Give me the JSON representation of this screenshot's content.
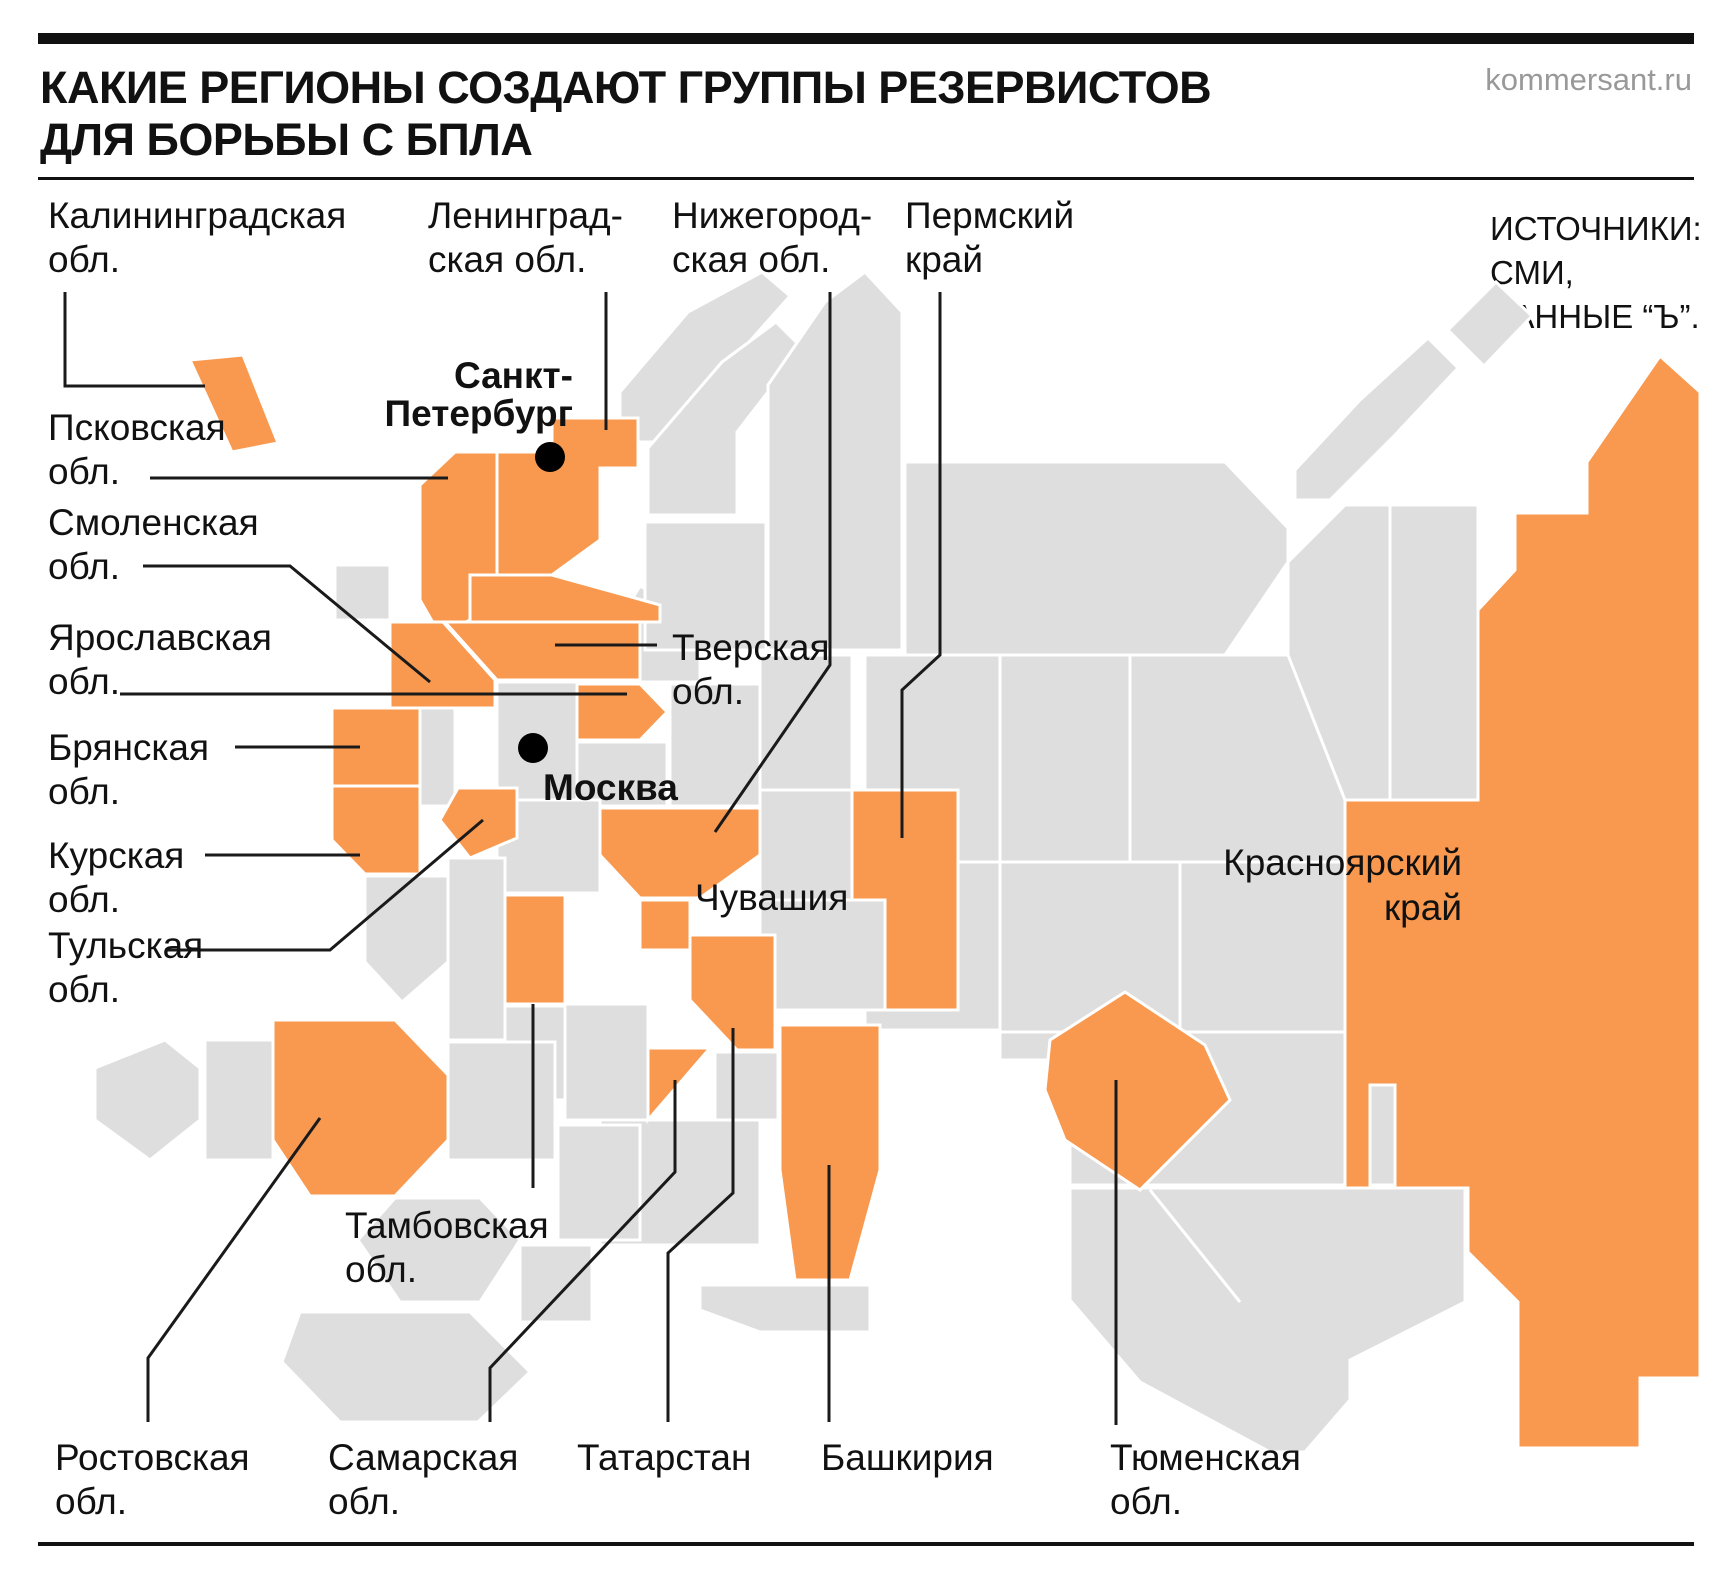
{
  "colors": {
    "accent": "#F9994F",
    "region": "#DEDEDE",
    "ink": "#111111",
    "muted": "#999999",
    "line": "#1A1A1A"
  },
  "header": {
    "title_line1": "КАКИЕ РЕГИОНЫ СОЗДАЮТ ГРУППЫ РЕЗЕРВИСТОВ",
    "title_line2": "ДЛЯ БОРЬБЫ С БПЛА",
    "site": "kommersant.ru"
  },
  "sources": {
    "line1": "ИСТОЧНИКИ:",
    "line2": "СМИ,",
    "line3": "ДАННЫЕ “Ъ”."
  },
  "cities": {
    "spb": [
      "Санкт-",
      "Петербург"
    ],
    "moscow": [
      "Москва"
    ]
  },
  "regions": {
    "kaliningrad": [
      "Калининградская",
      "обл."
    ],
    "leningrad": [
      "Ленинград-",
      "ская обл."
    ],
    "nizhny": [
      "Нижегород-",
      "ская обл."
    ],
    "perm": [
      "Пермский",
      "край"
    ],
    "pskov": [
      "Псковская",
      "обл."
    ],
    "smolensk": [
      "Смоленская",
      "обл."
    ],
    "tver": [
      "Тверская",
      "обл."
    ],
    "yaroslavl": [
      "Ярославская",
      "обл."
    ],
    "bryansk": [
      "Брянская",
      "обл."
    ],
    "kursk": [
      "Курская",
      "обл."
    ],
    "tula": [
      "Тульская",
      "обл."
    ],
    "chuvashia": [
      "Чувашия"
    ],
    "krasnoyarsk": [
      "Красноярский",
      "край"
    ],
    "tambov": [
      "Тамбовская",
      "обл."
    ],
    "rostov": [
      "Ростовская",
      "обл."
    ],
    "samara": [
      "Самарская",
      "обл."
    ],
    "tatarstan": [
      "Татарстан"
    ],
    "bashkiria": [
      "Башкирия"
    ],
    "tyumen": [
      "Тюменская",
      "обл."
    ]
  }
}
